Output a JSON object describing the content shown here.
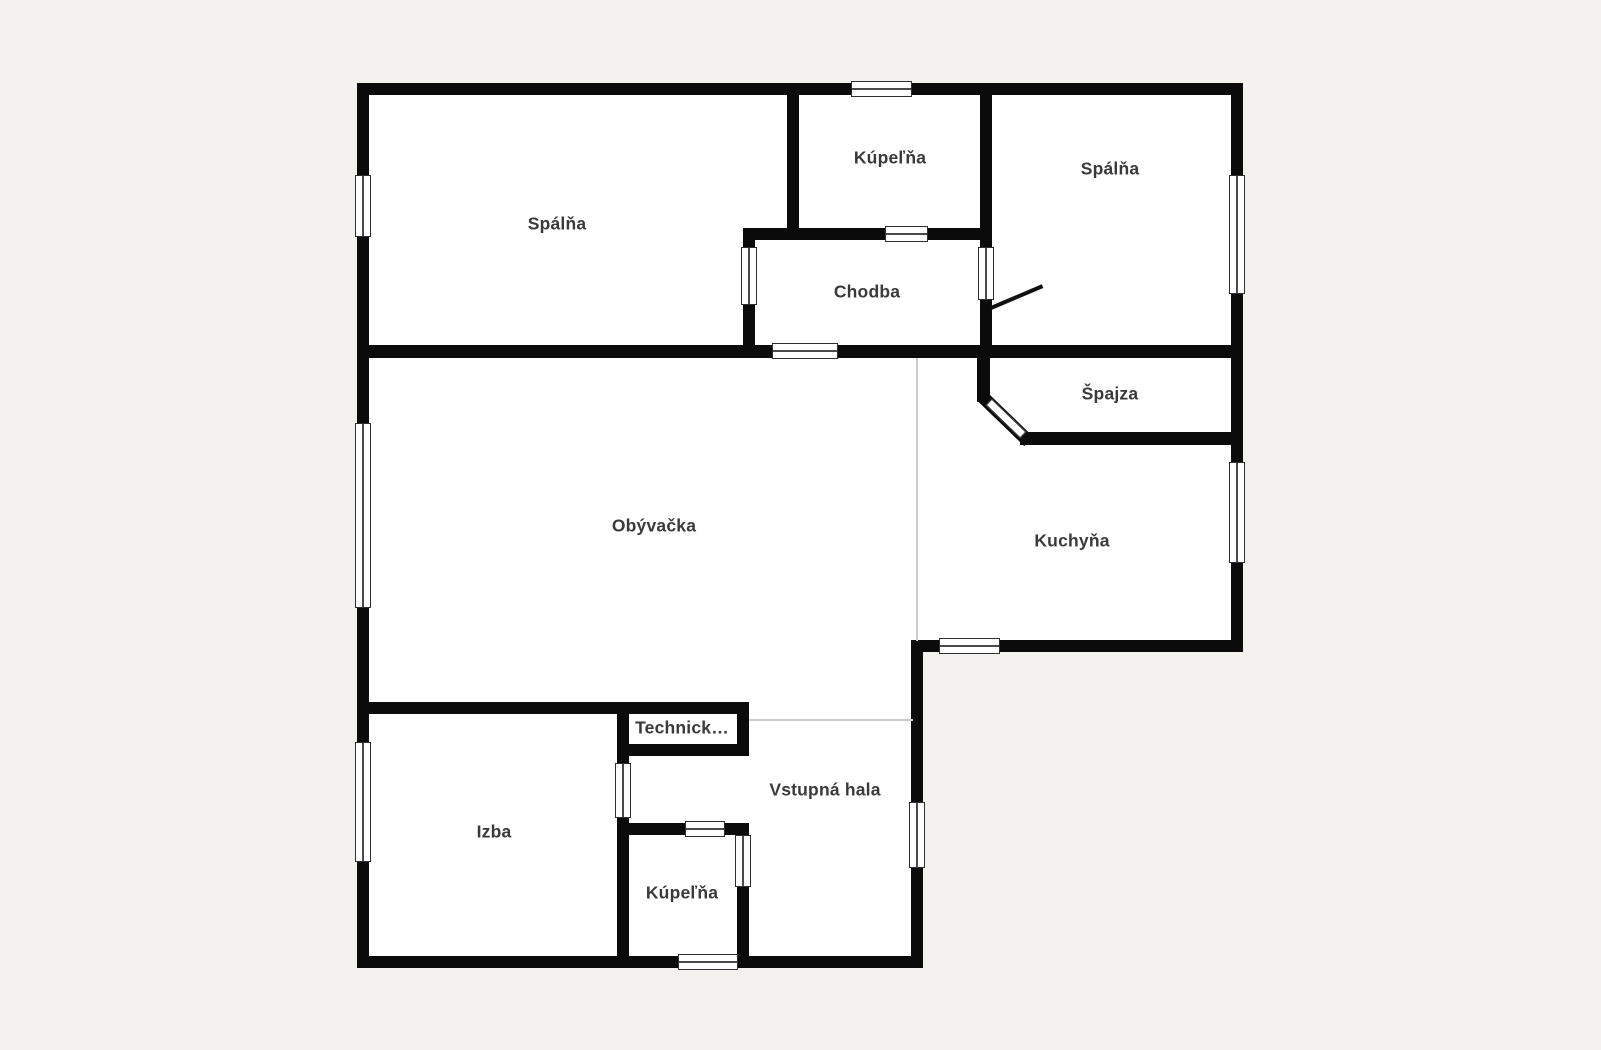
{
  "floorplan": {
    "rooms": [
      {
        "label": "Spálňa"
      },
      {
        "label": "Kúpeľňa"
      },
      {
        "label": "Spálňa"
      },
      {
        "label": "Chodba"
      },
      {
        "label": "Špajza"
      },
      {
        "label": "Obývačka"
      },
      {
        "label": "Kuchyňa"
      },
      {
        "label": "Izba"
      },
      {
        "label": "Technick…"
      },
      {
        "label": "Vstupná hala"
      },
      {
        "label": "Kúpeľňa"
      }
    ],
    "colors": {
      "background": "#f3f2ef",
      "room_fill": "#ffffff",
      "wall": "#0b0b0b",
      "label_text": "#3a3a3a",
      "open_boundary_line": "#cccccc",
      "window_outline": "#2e2e2e"
    }
  }
}
